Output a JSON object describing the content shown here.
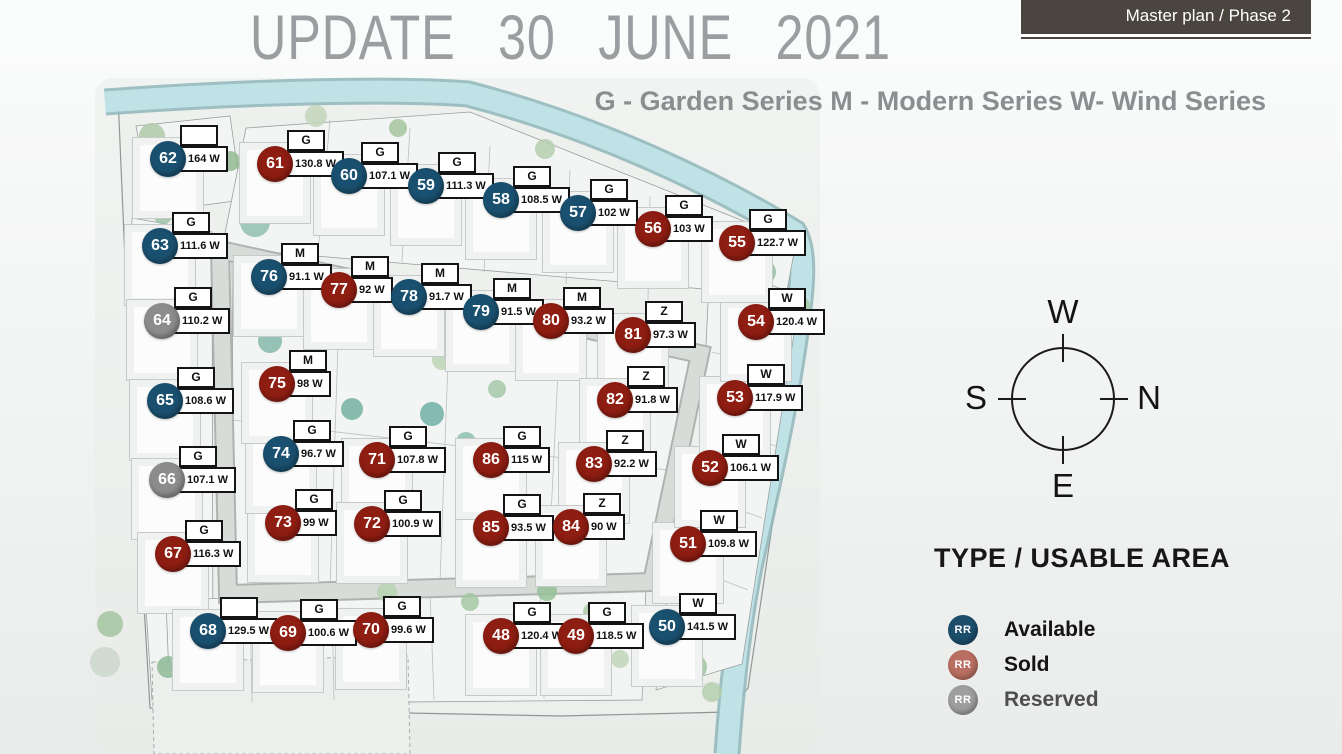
{
  "header": {
    "title": "UPDATE 30 JUNE 2021",
    "series_legend": "G - Garden Series M - Modern Series W- Wind Series"
  },
  "project": {
    "name": "THE RESORT VILLAS",
    "subtitle": "Master plan / Phase 2"
  },
  "compass": {
    "top": "W",
    "left": "S",
    "right": "N",
    "bottom": "E"
  },
  "legend": {
    "heading": "TYPE / USABLE AREA",
    "badge_text": "RR",
    "items": [
      {
        "label": "Available",
        "status": "available",
        "swatch": "#1c4e6b"
      },
      {
        "label": "Sold",
        "status": "sold",
        "swatch": "#b96f61"
      },
      {
        "label": "Reserved",
        "status": "reserved",
        "swatch": "#9e9e9e"
      }
    ]
  },
  "statuses": {
    "available": {
      "color": "#1a506f"
    },
    "sold": {
      "color": "#8e1d12"
    },
    "reserved": {
      "color": "#8c8c8c"
    }
  },
  "lots": [
    {
      "number": 48,
      "series": "G",
      "area": "120.4 W",
      "status": "sold",
      "x": 501,
      "y": 636
    },
    {
      "number": 49,
      "series": "G",
      "area": "118.5 W",
      "status": "sold",
      "x": 576,
      "y": 636
    },
    {
      "number": 50,
      "series": "W",
      "area": "141.5 W",
      "status": "available",
      "x": 667,
      "y": 627
    },
    {
      "number": 51,
      "series": "W",
      "area": "109.8 W",
      "status": "sold",
      "x": 688,
      "y": 544
    },
    {
      "number": 52,
      "series": "W",
      "area": "106.1 W",
      "status": "sold",
      "x": 710,
      "y": 468
    },
    {
      "number": 53,
      "series": "W",
      "area": "117.9 W",
      "status": "sold",
      "x": 735,
      "y": 398
    },
    {
      "number": 54,
      "series": "W",
      "area": "120.4 W",
      "status": "sold",
      "x": 756,
      "y": 322
    },
    {
      "number": 55,
      "series": "G",
      "area": "122.7 W",
      "status": "sold",
      "x": 737,
      "y": 243
    },
    {
      "number": 56,
      "series": "G",
      "area": "103 W",
      "status": "sold",
      "x": 653,
      "y": 229
    },
    {
      "number": 57,
      "series": "G",
      "area": "102 W",
      "status": "available",
      "x": 578,
      "y": 213
    },
    {
      "number": 58,
      "series": "G",
      "area": "108.5 W",
      "status": "available",
      "x": 501,
      "y": 200
    },
    {
      "number": 59,
      "series": "G",
      "area": "111.3 W",
      "status": "available",
      "x": 426,
      "y": 186
    },
    {
      "number": 60,
      "series": "G",
      "area": "107.1 W",
      "status": "available",
      "x": 349,
      "y": 176
    },
    {
      "number": 61,
      "series": "G",
      "area": "130.8 W",
      "status": "sold",
      "x": 275,
      "y": 164
    },
    {
      "number": 62,
      "series": "",
      "area": "164 W",
      "status": "available",
      "x": 168,
      "y": 159
    },
    {
      "number": 63,
      "series": "G",
      "area": "111.6 W",
      "status": "available",
      "x": 160,
      "y": 246
    },
    {
      "number": 64,
      "series": "G",
      "area": "110.2 W",
      "status": "reserved",
      "x": 162,
      "y": 321
    },
    {
      "number": 65,
      "series": "G",
      "area": "108.6 W",
      "status": "available",
      "x": 165,
      "y": 401
    },
    {
      "number": 66,
      "series": "G",
      "area": "107.1 W",
      "status": "reserved",
      "x": 167,
      "y": 480
    },
    {
      "number": 67,
      "series": "G",
      "area": "116.3 W",
      "status": "sold",
      "x": 173,
      "y": 554
    },
    {
      "number": 68,
      "series": "",
      "area": "129.5 W",
      "status": "available",
      "x": 208,
      "y": 631
    },
    {
      "number": 69,
      "series": "G",
      "area": "100.6 W",
      "status": "sold",
      "x": 288,
      "y": 633
    },
    {
      "number": 70,
      "series": "G",
      "area": "99.6 W",
      "status": "sold",
      "x": 371,
      "y": 630
    },
    {
      "number": 71,
      "series": "G",
      "area": "107.8 W",
      "status": "sold",
      "x": 377,
      "y": 460
    },
    {
      "number": 72,
      "series": "G",
      "area": "100.9 W",
      "status": "sold",
      "x": 372,
      "y": 524
    },
    {
      "number": 73,
      "series": "G",
      "area": "99 W",
      "status": "sold",
      "x": 283,
      "y": 523
    },
    {
      "number": 74,
      "series": "G",
      "area": "96.7 W",
      "status": "available",
      "x": 281,
      "y": 454
    },
    {
      "number": 75,
      "series": "M",
      "area": "98 W",
      "status": "sold",
      "x": 277,
      "y": 384
    },
    {
      "number": 76,
      "series": "M",
      "area": "91.1 W",
      "status": "available",
      "x": 269,
      "y": 277
    },
    {
      "number": 77,
      "series": "M",
      "area": "92 W",
      "status": "sold",
      "x": 339,
      "y": 290
    },
    {
      "number": 78,
      "series": "M",
      "area": "91.7 W",
      "status": "available",
      "x": 409,
      "y": 297
    },
    {
      "number": 79,
      "series": "M",
      "area": "91.5 W",
      "status": "available",
      "x": 481,
      "y": 312
    },
    {
      "number": 80,
      "series": "M",
      "area": "93.2 W",
      "status": "sold",
      "x": 551,
      "y": 321
    },
    {
      "number": 81,
      "series": "Z",
      "area": "97.3 W",
      "status": "sold",
      "x": 633,
      "y": 335
    },
    {
      "number": 82,
      "series": "Z",
      "area": "91.8 W",
      "status": "sold",
      "x": 615,
      "y": 400
    },
    {
      "number": 83,
      "series": "Z",
      "area": "92.2 W",
      "status": "sold",
      "x": 594,
      "y": 464
    },
    {
      "number": 84,
      "series": "Z",
      "area": "90 W",
      "status": "sold",
      "x": 571,
      "y": 527
    },
    {
      "number": 85,
      "series": "G",
      "area": "93.5 W",
      "status": "sold",
      "x": 491,
      "y": 528
    },
    {
      "number": 86,
      "series": "G",
      "area": "115 W",
      "status": "sold",
      "x": 491,
      "y": 460
    }
  ]
}
